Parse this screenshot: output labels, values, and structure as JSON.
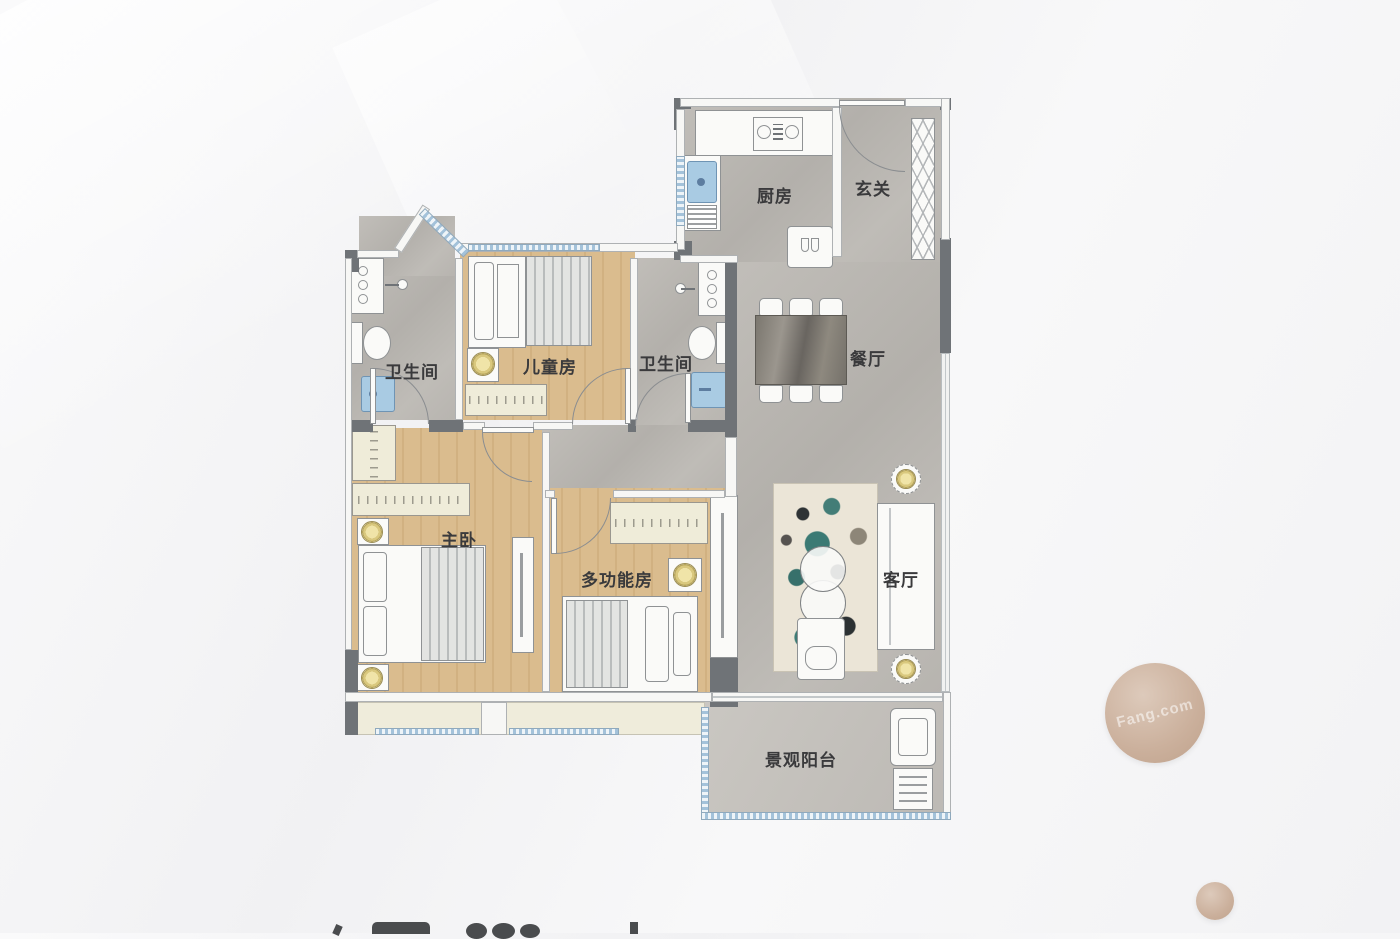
{
  "floorplan": {
    "rooms": {
      "kitchen": {
        "label": "厨房"
      },
      "foyer": {
        "label": "玄关"
      },
      "bath1": {
        "label": "卫生间"
      },
      "bath2": {
        "label": "卫生间"
      },
      "children": {
        "label": "儿童房"
      },
      "dining": {
        "label": "餐厅"
      },
      "master": {
        "label": "主卧"
      },
      "multi": {
        "label": "多功能房"
      },
      "living": {
        "label": "客厅"
      },
      "balcony": {
        "label": "景观阳台"
      }
    },
    "colors": {
      "wall_dark": "#6f7377",
      "floor_gray": "#bcb8b3",
      "floor_wood": "#dabc8e",
      "window_blue": "#a3c2da",
      "fixture_blue": "#a9cbe3",
      "lamp_yellow": "#e7d78e",
      "rug_teal": "#3b7a74",
      "watermark_beige": "#cbb09c"
    }
  },
  "watermark": {
    "text": "Fang.com"
  }
}
